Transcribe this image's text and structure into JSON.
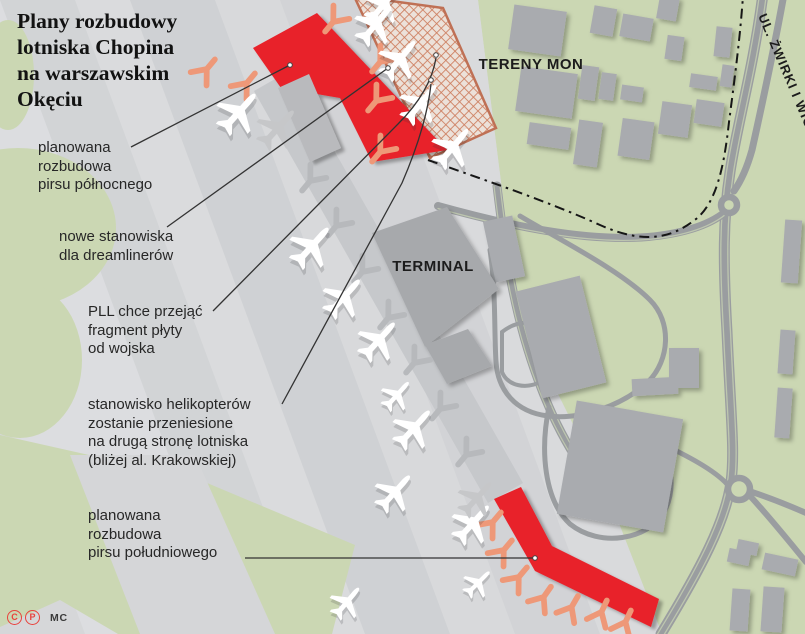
{
  "title": {
    "lines": [
      "Plany rozbudowy",
      "lotniska Chopina",
      "na warszawskim",
      "Okęciu"
    ]
  },
  "annotations": [
    {
      "id": "north-pier",
      "x": 38,
      "y": 139,
      "lines": [
        "planowana",
        "rozbudowa",
        "pirsu północnego"
      ]
    },
    {
      "id": "dreamliners",
      "x": 59,
      "y": 228,
      "lines": [
        "nowe stanowiska",
        "dla dreamlinerów"
      ]
    },
    {
      "id": "pll-apron",
      "x": 88,
      "y": 303,
      "lines": [
        "PLL chce przejąć",
        "fragment płyty",
        "od wojska"
      ]
    },
    {
      "id": "helicopters",
      "x": 88,
      "y": 396,
      "lines": [
        "stanowisko helikopterów",
        "zostanie przeniesione",
        "na drugą stronę lotniska",
        "(bliżej al. Krakowskiej)"
      ]
    },
    {
      "id": "south-pier",
      "x": 88,
      "y": 507,
      "lines": [
        "planowana",
        "rozbudowa",
        "pirsu południowego"
      ]
    }
  ],
  "credits": {
    "icon1": "C",
    "icon2": "P",
    "text": "MC"
  },
  "colors": {
    "green": "#cbd7b3",
    "apron": "#d6d7d9",
    "concourse": "#c6c8cb",
    "building": "#a9abaf",
    "terminal": "#a7a9ac",
    "road": "#9a9da0",
    "lane": "#bdc6af",
    "red": "#e8212b",
    "salmon": "#ee9878",
    "gray_stand": "#b7b9bc",
    "gray_pier": "#b9babd",
    "hatch_bg": "#ece1d9",
    "hatch_line": "#cd7d5e",
    "hatch_border": "#bf7055",
    "boundary": "#161616",
    "leader": "#333333"
  },
  "map": {
    "apron": "0,0 478,0 502,190 512,280 556,390 608,495 662,634 0,634",
    "stripes": [
      {
        "x": -150,
        "w": 150,
        "c": "#dcdde0"
      },
      {
        "x": 0,
        "w": 75,
        "c": "#d2d4d6"
      },
      {
        "x": 75,
        "w": 55,
        "c": "#dadbdd"
      },
      {
        "x": 130,
        "w": 85,
        "c": "#cfd1d4"
      },
      {
        "x": 215,
        "w": 65,
        "c": "#d8d9db"
      },
      {
        "x": 280,
        "w": 85,
        "c": "#d2d3d6"
      },
      {
        "x": 365,
        "w": 115,
        "c": "#d9dadc"
      },
      {
        "x": 480,
        "w": 220,
        "c": "#d4d5d7"
      }
    ],
    "stripe_skew": 235,
    "green_wedge": "0,435 200,480 355,545 332,634 118,634 60,600 0,627",
    "green_band_gray": "70,455 195,455 275,634 140,634",
    "green_blobs": [
      [
        8,
        75,
        26,
        55
      ],
      [
        18,
        228,
        98,
        80
      ],
      [
        20,
        360,
        62,
        78
      ]
    ],
    "concourse": "254,91 289,71 523,483 488,503",
    "terminal_polys": [
      "372,233 447,207 499,289 425,347",
      "425,345 468,329 492,366 447,384"
    ],
    "buildings": [
      [
        511,
        8,
        53,
        45,
        8
      ],
      [
        592,
        7,
        23,
        28,
        10
      ],
      [
        621,
        16,
        31,
        23,
        10
      ],
      [
        658,
        -4,
        20,
        24,
        10
      ],
      [
        715,
        27,
        16,
        30,
        6
      ],
      [
        666,
        36,
        17,
        24,
        8
      ],
      [
        518,
        70,
        57,
        45,
        8
      ],
      [
        580,
        66,
        17,
        34,
        8
      ],
      [
        600,
        73,
        15,
        27,
        8
      ],
      [
        621,
        86,
        22,
        15,
        8
      ],
      [
        690,
        75,
        27,
        14,
        8
      ],
      [
        721,
        65,
        12,
        22,
        8
      ],
      [
        528,
        125,
        42,
        22,
        8
      ],
      [
        576,
        121,
        24,
        45,
        8
      ],
      [
        620,
        120,
        32,
        38,
        8
      ],
      [
        660,
        103,
        30,
        33,
        8
      ],
      [
        695,
        101,
        28,
        24,
        8
      ],
      [
        489,
        218,
        30,
        62,
        -12
      ],
      [
        528,
        282,
        66,
        110,
        -14
      ],
      [
        632,
        378,
        46,
        17,
        -3
      ],
      [
        669,
        348,
        30,
        40,
        0
      ],
      [
        566,
        409,
        108,
        115,
        10
      ],
      [
        783,
        220,
        17,
        63,
        4
      ],
      [
        779,
        330,
        15,
        44,
        4
      ],
      [
        776,
        388,
        15,
        50,
        4
      ],
      [
        737,
        541,
        21,
        13,
        12
      ],
      [
        728,
        550,
        22,
        14,
        12
      ],
      [
        763,
        556,
        34,
        17,
        12
      ],
      [
        731,
        589,
        18,
        42,
        4
      ],
      [
        762,
        587,
        21,
        45,
        4
      ]
    ],
    "roads": [
      {
        "d": "M 763,-6 C 753,70 737,125 730,172 C 723,218 723,262 727,332 C 731,420 735,452 731,482 C 726,521 700,570 661,634",
        "w": 11
      },
      {
        "d": "M 763,-6 C 753,70 737,125 730,172 C 723,218 723,262 727,332 C 731,420 735,452 731,482 C 726,521 700,570 661,634",
        "w": 1.3,
        "c": "lane",
        "t": "translate(-3.5,0)"
      },
      {
        "d": "M 763,-6 C 753,70 737,125 730,172 C 723,218 723,262 727,332 C 731,420 735,452 731,482 C 726,521 700,570 661,634",
        "w": 1.3,
        "c": "lane",
        "t": "translate(3.5,0)"
      },
      {
        "d": "M 784,-6 C 773,55 762,105 752,150 C 747,168 741,181 734,191",
        "w": 7
      },
      {
        "d": "M 438,206 C 510,226 585,242 648,237 C 690,233 715,222 729,209",
        "w": 8
      },
      {
        "d": "M 438,206 C 510,226 585,242 648,237 C 690,233 715,222 729,209",
        "w": 1.2,
        "c": "lane",
        "t": "translate(0,2.5)"
      },
      {
        "d": "M 497,186 C 505,252 515,330 549,407 C 570,455 597,492 625,516",
        "w": 9
      },
      {
        "d": "M 497,186 C 505,252 515,330 549,407 C 570,455 597,492 625,516",
        "w": 1.2,
        "c": "lane",
        "t": "translate(-3,0)"
      },
      {
        "d": "M 497,186 C 505,252 515,330 549,407 C 570,455 597,492 625,516",
        "w": 1.2,
        "c": "lane",
        "t": "translate(3,0)"
      },
      {
        "d": "M 520,216 C 560,240 620,270 650,300 C 672,322 670,360 648,382 C 622,406 580,420 548,416 C 515,412 498,390 496,362 C 494,330 496,290 490,250",
        "w": 5
      },
      {
        "d": "M 502,332 C 520,318 540,320 552,336 C 564,352 558,372 542,381 C 526,390 508,386 502,372 Z",
        "w": 4
      },
      {
        "d": "M 549,407 C 540,450 544,500 570,524 C 600,548 648,540 664,512 C 676,490 672,462 658,442",
        "w": 5
      },
      {
        "d": "M 658,442 C 688,456 714,470 727,484",
        "w": 5
      },
      {
        "d": "M 752,492 C 770,498 790,506 806,513",
        "w": 6
      },
      {
        "d": "M 751,497 C 772,520 792,545 806,562",
        "w": 6
      }
    ],
    "roundabouts": [
      [
        729,
        205,
        8
      ],
      [
        739,
        489,
        11
      ]
    ],
    "boundary": "M 428,160 C 470,175 545,200 600,225 C 645,245 672,238 696,219 C 716,203 724,168 729,122 C 735,76 740,38 743,-4",
    "hatch_poly": "354,-4 443,8 496,128 430,158",
    "piers": {
      "north_red": "253,48 317,13 447,150 372,162 340,98 281,88",
      "north_gray": "278,88 309,74 341,148 310,162",
      "south_red": "494,499 521,487 552,546 659,599 651,627 535,571"
    },
    "stands": [
      [
        206,
        70,
        220,
        "s"
      ],
      [
        246,
        84,
        220,
        "s"
      ],
      [
        334,
        21,
        40,
        "s"
      ],
      [
        381,
        61,
        40,
        "s"
      ],
      [
        377,
        100,
        40,
        "s"
      ],
      [
        381,
        151,
        40,
        "s"
      ],
      [
        492,
        523,
        220,
        "s"
      ],
      [
        503,
        551,
        220,
        "s"
      ],
      [
        518,
        578,
        220,
        "s"
      ],
      [
        543,
        598,
        215,
        "s"
      ],
      [
        571,
        608,
        210,
        "s"
      ],
      [
        601,
        613,
        205,
        "s"
      ],
      [
        625,
        623,
        205,
        "s"
      ],
      [
        311,
        180,
        40,
        "g"
      ],
      [
        337,
        225,
        40,
        "g"
      ],
      [
        363,
        271,
        40,
        "g"
      ],
      [
        389,
        317,
        40,
        "g"
      ],
      [
        415,
        362,
        40,
        "g"
      ],
      [
        441,
        408,
        40,
        "g"
      ],
      [
        467,
        454,
        40,
        "g"
      ]
    ],
    "planes": [
      [
        239,
        112,
        42,
        1.05,
        0
      ],
      [
        312,
        246,
        42,
        1.05,
        0
      ],
      [
        344,
        297,
        42,
        1.0,
        0
      ],
      [
        379,
        340,
        42,
        1.0,
        0
      ],
      [
        414,
        428,
        42,
        1.0,
        0
      ],
      [
        473,
        523,
        42,
        1.0,
        0
      ],
      [
        397,
        395,
        42,
        0.75,
        0
      ],
      [
        395,
        492,
        42,
        0.95,
        0
      ],
      [
        478,
        583,
        45,
        0.7,
        0
      ],
      [
        347,
        602,
        40,
        0.8,
        0
      ],
      [
        384,
        4,
        40,
        0.95,
        0
      ],
      [
        376,
        24,
        40,
        1.0,
        0
      ],
      [
        400,
        59,
        40,
        1.0,
        0
      ],
      [
        421,
        103,
        40,
        1.0,
        0
      ],
      [
        453,
        147,
        40,
        1.0,
        0
      ],
      [
        278,
        128,
        42,
        1.0,
        1
      ],
      [
        477,
        498,
        42,
        0.9,
        1
      ]
    ],
    "leaders": [
      {
        "d": "M 131,147 L 290,65",
        "dot": [
          290,
          65
        ]
      },
      {
        "d": "M 167,227 L 388,68",
        "dot": [
          388,
          68
        ]
      },
      {
        "d": "M 213,311 L 398,124 C 418,104 432,82 436,58",
        "dot": [
          436,
          55
        ]
      },
      {
        "d": "M 282,404 L 402,183 C 418,146 428,112 431,84",
        "dot": [
          431,
          80
        ]
      },
      {
        "d": "M 245,558 L 534,558",
        "dot": [
          535,
          558
        ]
      }
    ],
    "labels": [
      {
        "id": "tereny-mon",
        "text": "TERENY MON",
        "x": 531,
        "y": 69,
        "size": 15,
        "weight": 700,
        "ls": 0.5,
        "anchor": "middle",
        "transform": ""
      },
      {
        "id": "terminal",
        "text": "TERMINAL",
        "x": 433,
        "y": 271,
        "size": 15,
        "weight": 700,
        "ls": 0.5,
        "anchor": "middle",
        "transform": ""
      },
      {
        "id": "street",
        "text": "UL. ŻWIRKI I WIGURY",
        "x": 0,
        "y": 0,
        "size": 13,
        "weight": 700,
        "ls": 1,
        "anchor": "start",
        "transform": "translate(758,16) rotate(67)"
      }
    ]
  }
}
